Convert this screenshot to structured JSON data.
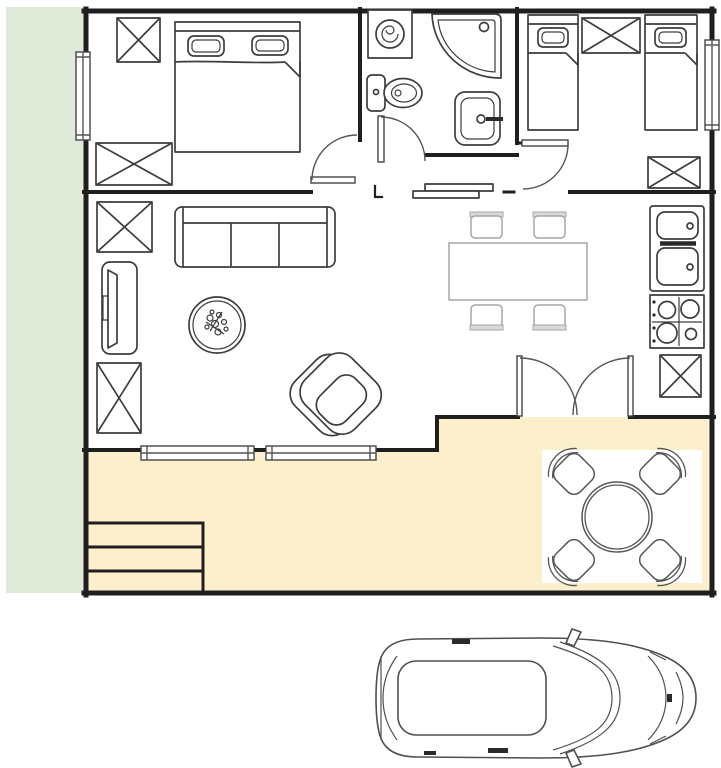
{
  "page": {
    "type": "floor-plan-drawing",
    "description": "Top-view apartment floor plan with garden strip, patio and a car drawn below"
  },
  "colors": {
    "background": "#ffffff",
    "garden": "#dfead8",
    "patio": "#fcefcb",
    "mat": "#ffffff",
    "wall": "#1f1f1f",
    "furniture": "#3d3d3d",
    "dining": "#a6a6a6",
    "car": "#4f4f4f"
  },
  "areas": {
    "garden_strip": "planted strip along left edge",
    "bedroom_left": [
      "wardrobe-box",
      "double-bed",
      "wide-wardrobe-box",
      "window",
      "swing-door"
    ],
    "bathroom": [
      "washing-machine",
      "corner-shower",
      "toilet",
      "wash-basin",
      "swing-door"
    ],
    "bedroom_right": [
      "single-bed",
      "wardrobe-box",
      "single-bed",
      "window",
      "wardrobe-box",
      "swing-door"
    ],
    "hallway": [
      "shoe-bench"
    ],
    "living_room": [
      "wardrobe-box",
      "three-seat-sofa",
      "tv-cabinet",
      "round-plant-table",
      "armchair",
      "tall-wardrobe-box",
      "window",
      "window"
    ],
    "dining_area": [
      "dining-table",
      "chair",
      "chair",
      "chair",
      "chair"
    ],
    "kitchen_corner": [
      "double-sink-counter",
      "gas-hob",
      "wardrobe-box"
    ],
    "patio": [
      "french-double-door",
      "white-mat",
      "round-garden-table",
      "garden-chair",
      "garden-chair",
      "garden-chair",
      "garden-chair",
      "steps-three"
    ],
    "outside": [
      "car-top-view"
    ]
  },
  "counts": {
    "crossed_storage_boxes": 7,
    "beds": 3,
    "windows": 4,
    "swing_doors": 4,
    "dining_chairs": 4,
    "garden_chairs": 4,
    "patio_steps": 3
  }
}
